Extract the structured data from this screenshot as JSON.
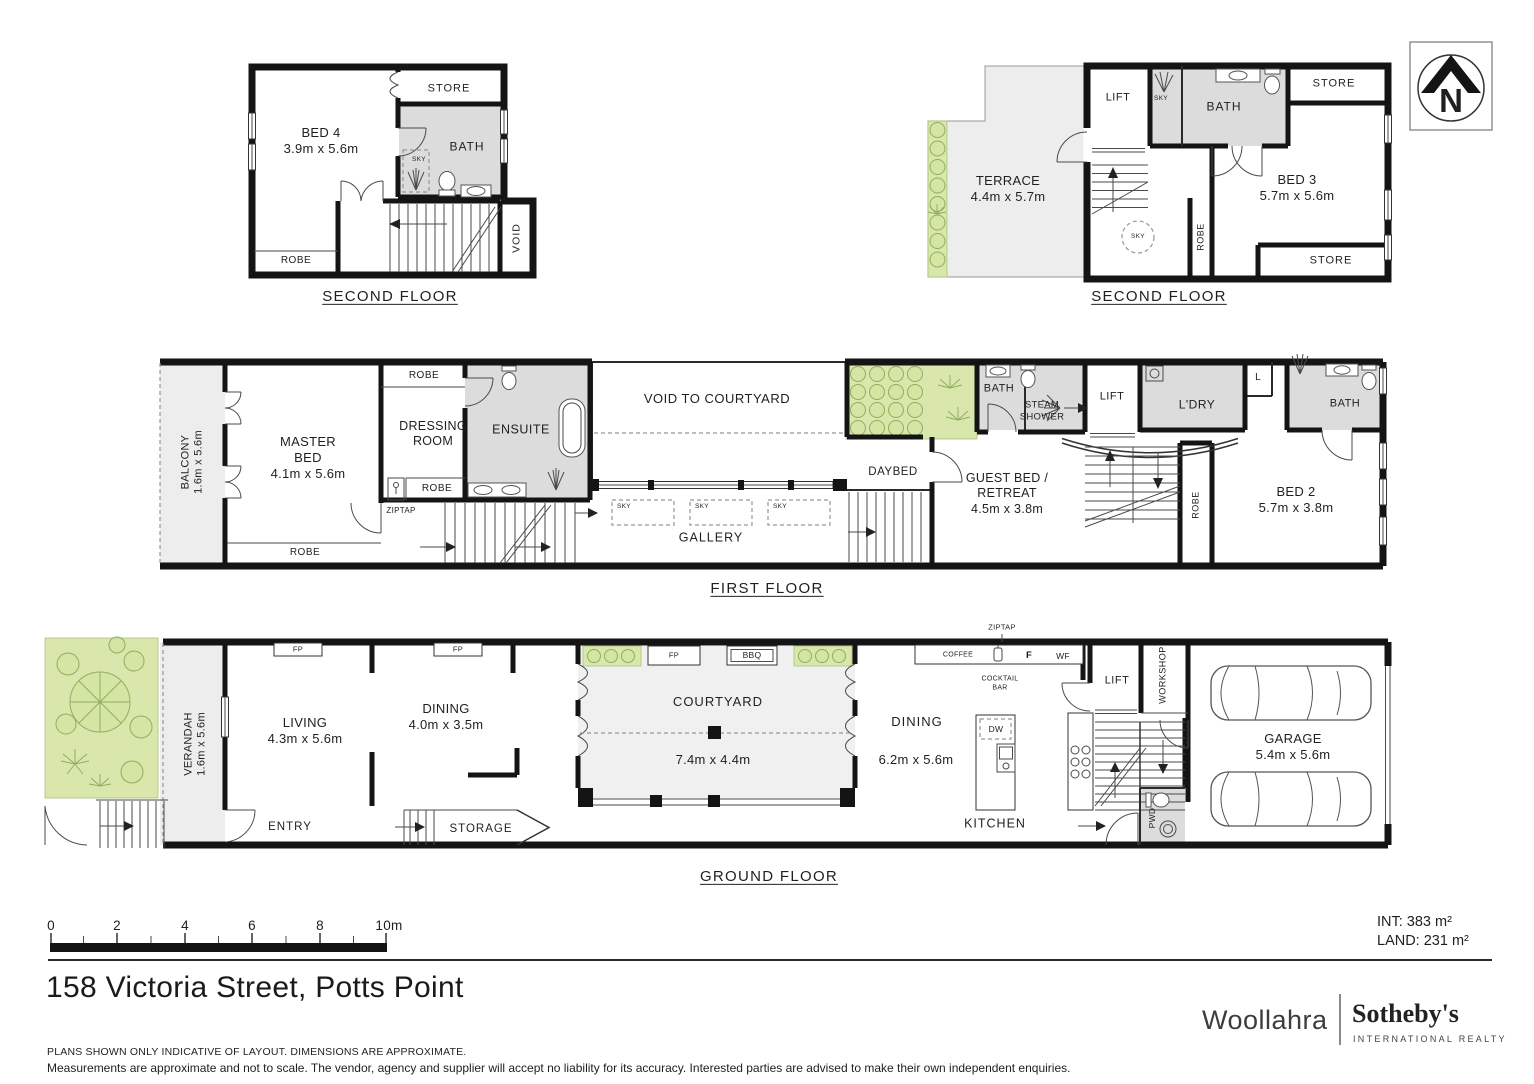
{
  "north": {
    "letter": "N"
  },
  "scalebar": {
    "ticks": [
      "0",
      "2",
      "4",
      "6",
      "8",
      "10m"
    ]
  },
  "areas": {
    "int": "INT: 383 m²",
    "land": "LAND: 231 m²"
  },
  "title": "158 Victoria Street, Potts Point",
  "disclaimers": {
    "line1": "PLANS SHOWN ONLY INDICATIVE OF LAYOUT. DIMENSIONS ARE APPROXIMATE.",
    "line2": "Measurements are approximate and not to scale. The vendor, agency and supplier will accept no liability for its accuracy. Interested parties are advised to make their own independent enquiries."
  },
  "logo": {
    "brand": "Woollahra",
    "name": "Sotheby's",
    "tagline": "INTERNATIONAL REALTY"
  },
  "sf_left": {
    "title": "SECOND FLOOR",
    "bed4": "BED 4\n3.9m x 5.6m",
    "store": "STORE",
    "bath": "BATH",
    "sky": "SKY",
    "robe": "ROBE",
    "void_label": "VOID"
  },
  "sf_right": {
    "title": "SECOND FLOOR",
    "terrace": "TERRACE\n4.4m x 5.7m",
    "lift": "LIFT",
    "sky": "SKY",
    "bath": "BATH",
    "store_top": "STORE",
    "bed3": "BED 3\n5.7m x 5.6m",
    "robe": "ROBE",
    "sky2": "SKY",
    "store_bottom": "STORE"
  },
  "first": {
    "title": "FIRST FLOOR",
    "balcony": "BALCONY\n1.6m x 5.6m",
    "master": "MASTER\nBED\n4.1m x 5.6m",
    "robe_top": "ROBE",
    "dressing": "DRESSING\nROOM",
    "ensuite": "ENSUITE",
    "robe_mid": "ROBE",
    "ziptap": "ZIPTAP",
    "robe_bottom": "ROBE",
    "void_courtyard": "VOID TO COURTYARD",
    "sky1": "SKY",
    "sky2": "SKY",
    "sky3": "SKY",
    "gallery": "GALLERY",
    "daybed": "DAYBED",
    "bath1": "BATH",
    "steam": "STEAM\nSHOWER",
    "lift": "LIFT",
    "ldry": "L'DRY",
    "l": "L",
    "bath2": "BATH",
    "guest": "GUEST BED /\nRETREAT\n4.5m x 3.8m",
    "robe_right": "ROBE",
    "bed2": "BED 2\n5.7m x 3.8m"
  },
  "ground": {
    "title": "GROUND FLOOR",
    "verandah": "VERANDAH\n1.6m x 5.6m",
    "living": "LIVING\n4.3m x 5.6m",
    "fp1": "FP",
    "fp2": "FP",
    "dining1": "DINING\n4.0m x 3.5m",
    "entry": "ENTRY",
    "storage": "STORAGE",
    "courtyard": "COURTYARD",
    "courtyard_dim": "7.4m x 4.4m",
    "fp3": "FP",
    "bbq": "BBQ",
    "dining2": "DINING",
    "dining2_dim": "6.2m x 5.6m",
    "ziptap": "ZIPTAP",
    "coffee": "COFFEE",
    "cocktail": "COCKTAIL\nBAR",
    "f": "F",
    "wf": "WF",
    "dw": "DW",
    "kitchen": "KITCHEN",
    "lift": "LIFT",
    "workshop": "WORKSHOP",
    "pwd": "PWD",
    "garage": "GARAGE\n5.4m x 5.6m"
  }
}
